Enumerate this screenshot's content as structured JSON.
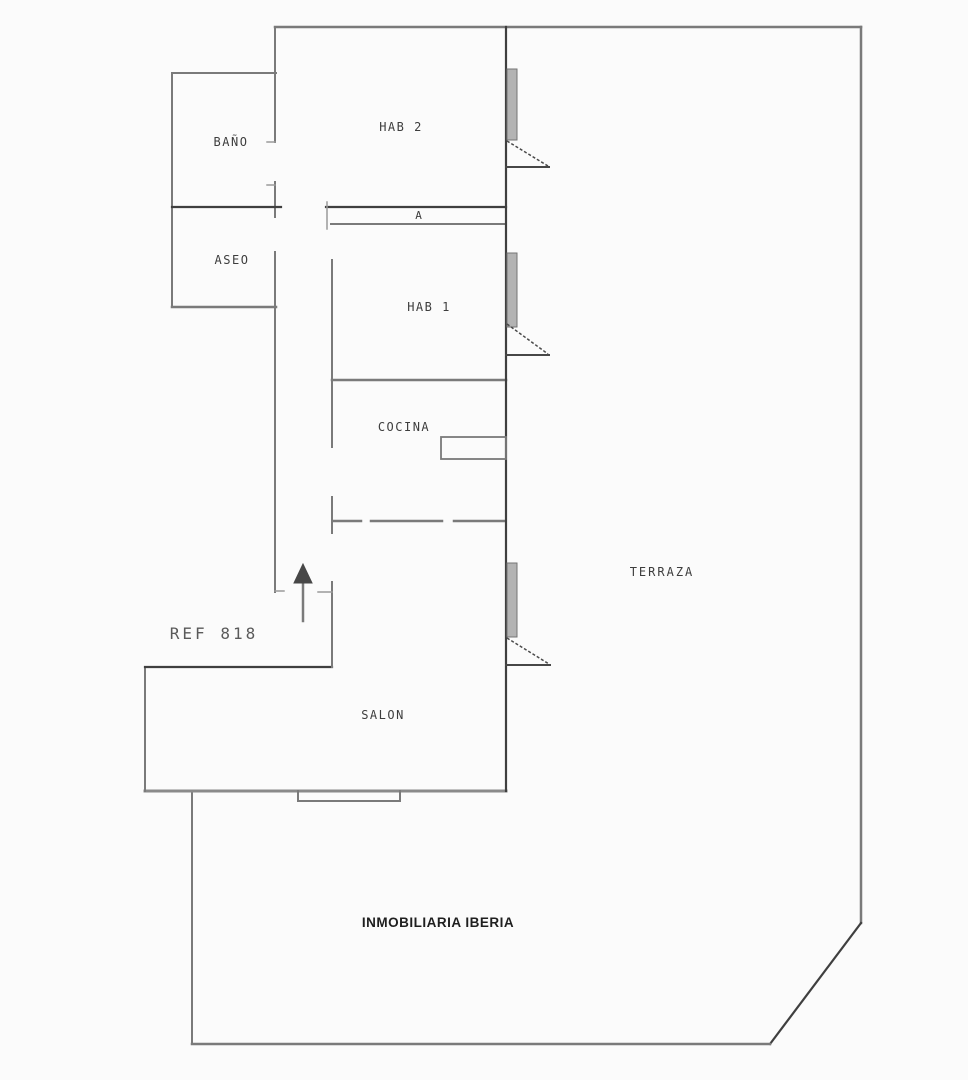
{
  "document": {
    "type": "floor-plan",
    "reference": "REF 818",
    "agency": "INMOBILIARIA IBERIA"
  },
  "labels": {
    "bano": "BAÑO",
    "aseo": "ASEO",
    "hab2": "HAB 2",
    "armario": "A",
    "hab1": "HAB 1",
    "cocina": "COCINA",
    "terraza": "TERRAZA",
    "salon": "SALON",
    "ref": "REF 818",
    "watermark": "INMOBILIARIA IBERIA"
  },
  "colors": {
    "background": "#fbfbfb",
    "wall_gray": "#7a7a7a",
    "wall_dark": "#3f3f3f",
    "label_text": "#3d3d3d",
    "ref_text": "#5a5a5a",
    "watermark_text": "#1f1f1f"
  },
  "symbols": [
    "entrance-arrow-icon",
    "window-swing-symbol-hab2",
    "window-swing-symbol-hab1",
    "window-swing-symbol-salon",
    "wardrobe-strip",
    "kitchen-counter"
  ]
}
